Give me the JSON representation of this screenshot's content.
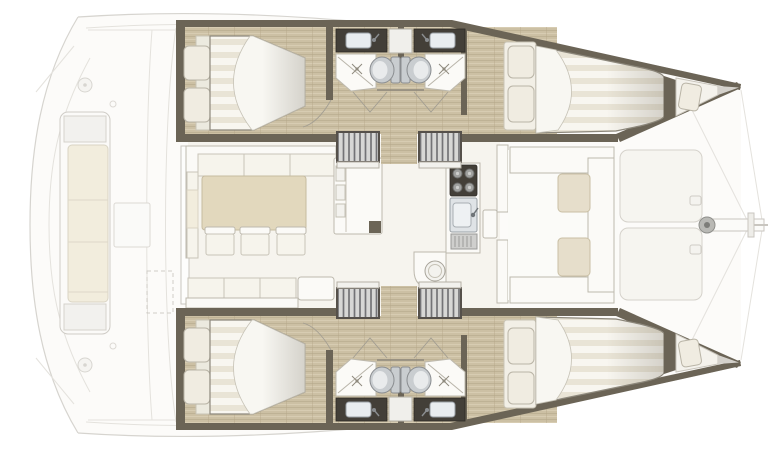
{
  "diagram": {
    "type": "boat-floorplan",
    "vessel": "catamaran",
    "view": "overhead deck plan",
    "bow_direction": "right",
    "hull_count": 2,
    "cabin_count": 4,
    "head_count": 4
  },
  "areas": {
    "aft_cockpit": {
      "features": [
        "transom-bench-seat",
        "bench-cushion",
        "cockpit-table",
        "deck-fitting-circles",
        "liferaft-locker-dashed",
        "swim-platform-outlines"
      ]
    },
    "salon": {
      "features": [
        "l-shaped-sofa",
        "dining-table",
        "three-chairs",
        "sideboard-unit",
        "aft-settee",
        "coffee-table"
      ]
    },
    "galley": {
      "features": [
        "four-burner-stove",
        "galley-sink",
        "drainer-hatch",
        "round-basin-peninsula"
      ]
    },
    "port_hull": {
      "rooms": [
        "aft-double-cabin",
        "head-with-shower-toilet-vanity",
        "companionway-stairs",
        "forward-double-cabin",
        "forepeak-berth"
      ]
    },
    "starboard_hull": {
      "rooms": [
        "aft-double-cabin",
        "head-with-shower-toilet-vanity",
        "companionway-stairs",
        "forward-double-cabin",
        "forepeak-berth"
      ]
    },
    "forward_cockpit": {
      "features": [
        "facing-bench-seats",
        "two-lounge-cushions",
        "door-to-salon"
      ]
    },
    "foredeck": {
      "features": [
        "two-sunpads",
        "bowsprit",
        "anchor-roller-fitting",
        "bow-rigging-lines"
      ]
    }
  },
  "palette": {
    "background": "#ffffff",
    "outline_faint": "#d6d4cf",
    "deck_fill": "#fcfbf9",
    "wall": "#6b6456",
    "wall_dark": "#55504a",
    "wood_base": "#ccc0a4",
    "wood_grain_dark": "#b3a588",
    "wood_grain_light": "#dad0b6",
    "upholstery_white": "#f8f6f0",
    "upholstery_stripe": "#e9e4d6",
    "cushion_cream": "#f2eddd",
    "cushion_tan": "#e6decb",
    "table_tan": "#e2d8bd",
    "fixture_metal": "#c9cdd0",
    "counter_dark": "#433f38",
    "basin_white": "#eef1f3",
    "stair_tread": "#d7d7d5",
    "stair_hatch": "#737376"
  }
}
